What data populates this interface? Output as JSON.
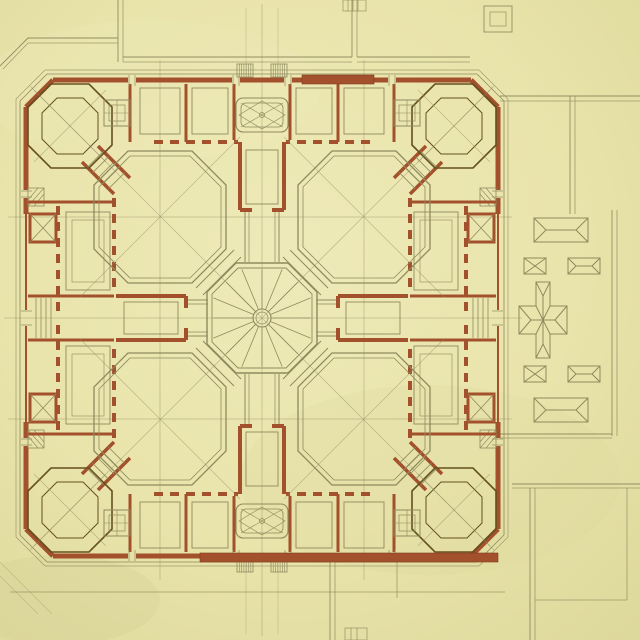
{
  "document": {
    "type": "scanned architectural drawing",
    "subject": "floor plan of a square palace with four octagonal corner pavilions, four octagonal inner courtyards and a central octagonal rotunda, with roof plans of outbuildings to the east",
    "media": "red ink and graphite on yellowed paper",
    "visible_text": "none"
  },
  "palette": {
    "paper": "#e9e4ab",
    "paper_light": "#f0ebbd",
    "paper_dark": "#dcd79a",
    "wall_red": "#a3512c",
    "wall_red_deep": "#83391a",
    "line_olive": "#8f8a5e",
    "line_olive_dark": "#6f6a45",
    "room_brown": "#64501f",
    "pencil": "#8f8962"
  },
  "plan": {
    "center": {
      "x": 262,
      "y": 318
    },
    "outer_walls": {
      "north_y": 80,
      "south_y": 556,
      "west_x": 26,
      "east_x": 498,
      "corner_chamfer": 27
    },
    "central_rotunda": {
      "shape": "octagon",
      "half_width": 55,
      "inner_half_width": 50,
      "radial_lines": 16,
      "hub_radius_outer": 9,
      "hub_radius_inner": 6
    },
    "inner_courts": {
      "count": 4,
      "shape": "octagon",
      "half_width": 66,
      "chamfer": 34,
      "centers": [
        {
          "x": 160,
          "y": 217
        },
        {
          "x": 364,
          "y": 217
        },
        {
          "x": 160,
          "y": 419
        },
        {
          "x": 364,
          "y": 419
        }
      ]
    },
    "corner_pavilions": {
      "count": 4,
      "room_shape": "octagon",
      "centers": [
        {
          "x": 70,
          "y": 126
        },
        {
          "x": 454,
          "y": 126
        },
        {
          "x": 70,
          "y": 510
        },
        {
          "x": 454,
          "y": 510
        }
      ]
    },
    "side_halls": {
      "count": 4,
      "positions": [
        "north",
        "east",
        "south",
        "west"
      ]
    },
    "ornament_panels": {
      "count": 2,
      "positions": [
        "north",
        "south"
      ]
    },
    "stair_combs": {
      "count": 4,
      "ticks": 6
    }
  },
  "annex_east": {
    "description": "roof plans of outbuildings east of the palace",
    "roofs": [
      {
        "kind": "hipped-rectangle",
        "x": 534,
        "y": 218,
        "w": 54,
        "h": 24
      },
      {
        "kind": "x-square",
        "x": 524,
        "y": 258,
        "w": 22,
        "h": 16
      },
      {
        "kind": "hipped-rectangle",
        "x": 568,
        "y": 258,
        "w": 32,
        "h": 16
      },
      {
        "kind": "cross-building",
        "x": 519,
        "y": 282,
        "w": 48,
        "h": 76
      },
      {
        "kind": "x-square",
        "x": 524,
        "y": 366,
        "w": 22,
        "h": 16
      },
      {
        "kind": "hipped-rectangle",
        "x": 568,
        "y": 366,
        "w": 32,
        "h": 16
      },
      {
        "kind": "hipped-rectangle",
        "x": 534,
        "y": 398,
        "w": 54,
        "h": 24
      }
    ]
  }
}
